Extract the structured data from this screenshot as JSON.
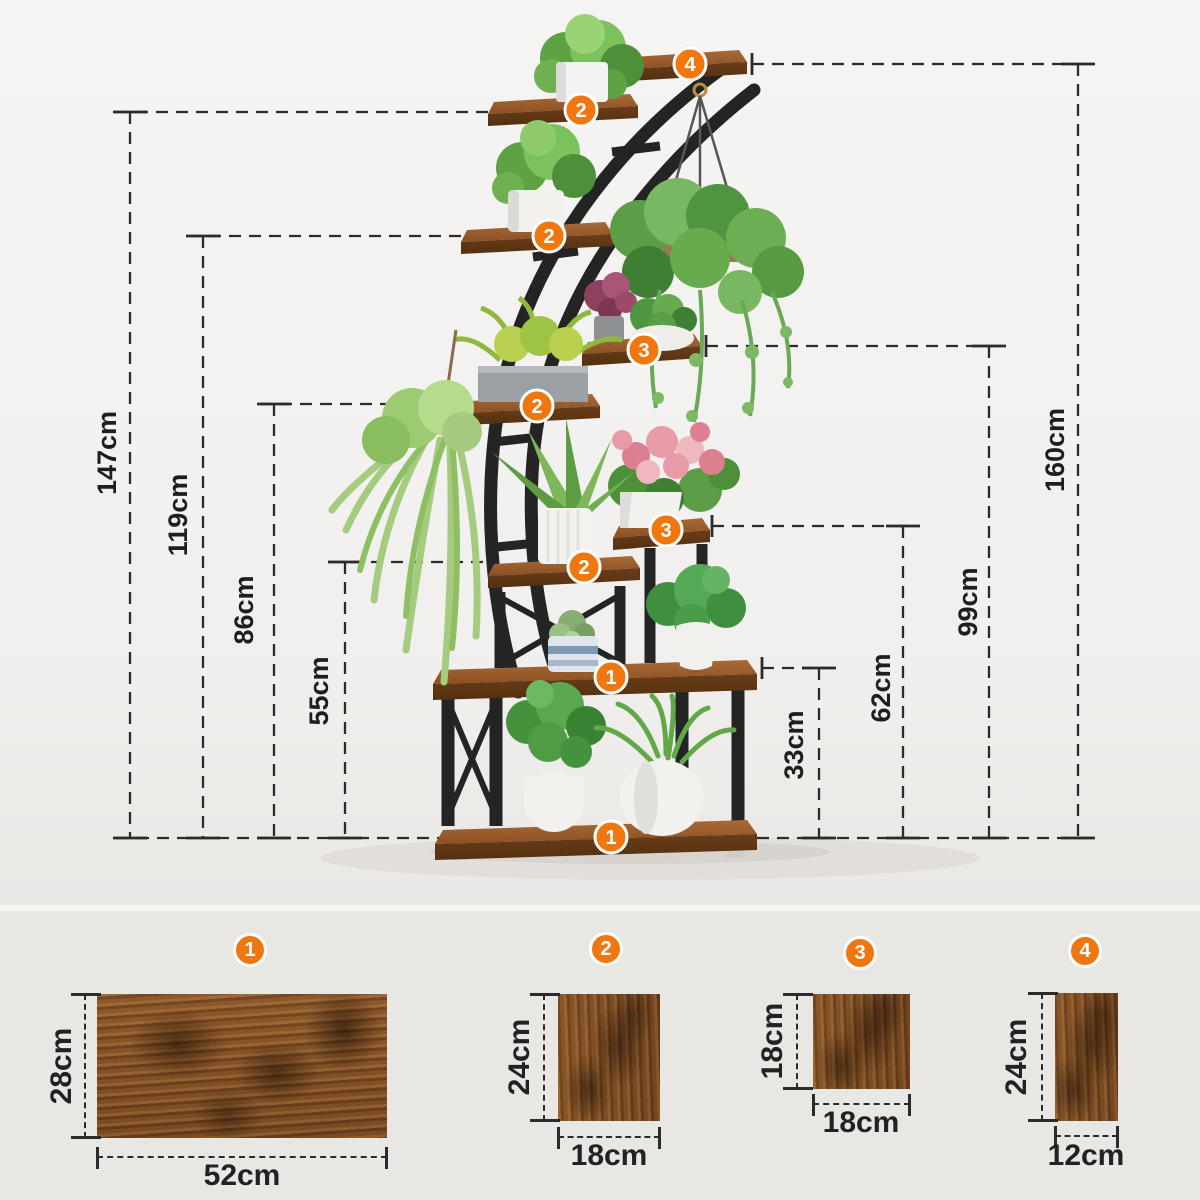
{
  "stand": {
    "left_dimensions": [
      {
        "label": "147cm"
      },
      {
        "label": "119cm"
      },
      {
        "label": "86cm"
      },
      {
        "label": "55cm"
      }
    ],
    "right_dimensions": [
      {
        "label": "33cm"
      },
      {
        "label": "62cm"
      },
      {
        "label": "99cm"
      },
      {
        "label": "160cm"
      }
    ]
  },
  "badges": {
    "b1": "1",
    "b2": "2",
    "b3": "3",
    "b4": "4"
  },
  "boards": [
    {
      "badge": "1",
      "height": "28cm",
      "width": "52cm"
    },
    {
      "badge": "2",
      "height": "24cm",
      "width": "18cm"
    },
    {
      "badge": "3",
      "height": "18cm",
      "width": "18cm"
    },
    {
      "badge": "4",
      "height": "24cm",
      "width": "12cm"
    }
  ],
  "colors": {
    "badge_orange": "#f0770f",
    "dimension_line": "#2b2b2b",
    "metal_frame": "#242424",
    "wood_top": "#9a6132"
  }
}
